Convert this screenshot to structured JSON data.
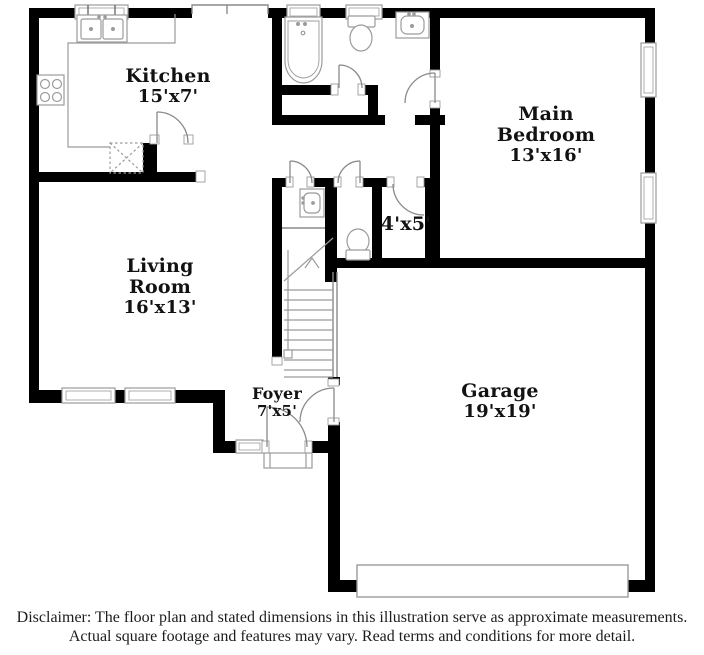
{
  "floor_plan": {
    "rooms": {
      "kitchen": {
        "name": "Kitchen",
        "dims": "15'x7'"
      },
      "main_bedroom": {
        "name": "Main Bedroom",
        "dims": "13'x16'"
      },
      "living_room": {
        "name": "Living Room",
        "dims": "16'x13'"
      },
      "closet": {
        "dims": "4'x5'"
      },
      "foyer": {
        "name": "Foyer",
        "dims": "7'x5'"
      },
      "garage": {
        "name": "Garage",
        "dims": "19'x19'"
      }
    },
    "fixtures": [
      "kitchen-sink",
      "stove-cooktop",
      "pantry-cabinet",
      "bathtub",
      "toilet",
      "bathroom-vanity-sink",
      "powder-room-vanity-sink",
      "powder-room-toilet",
      "staircase",
      "front-door",
      "garage-door",
      "porch-step",
      "windows"
    ],
    "colors": {
      "wall": "#000000",
      "fixture_line": "#9b9b9b",
      "text": "#121212",
      "background": "#ffffff"
    }
  },
  "disclaimer": {
    "line1": "Disclaimer: The floor plan and stated dimensions in this illustration serve as approximate measurements.",
    "line2": "Actual square footage and features may vary. Read terms and conditions for more detail."
  }
}
